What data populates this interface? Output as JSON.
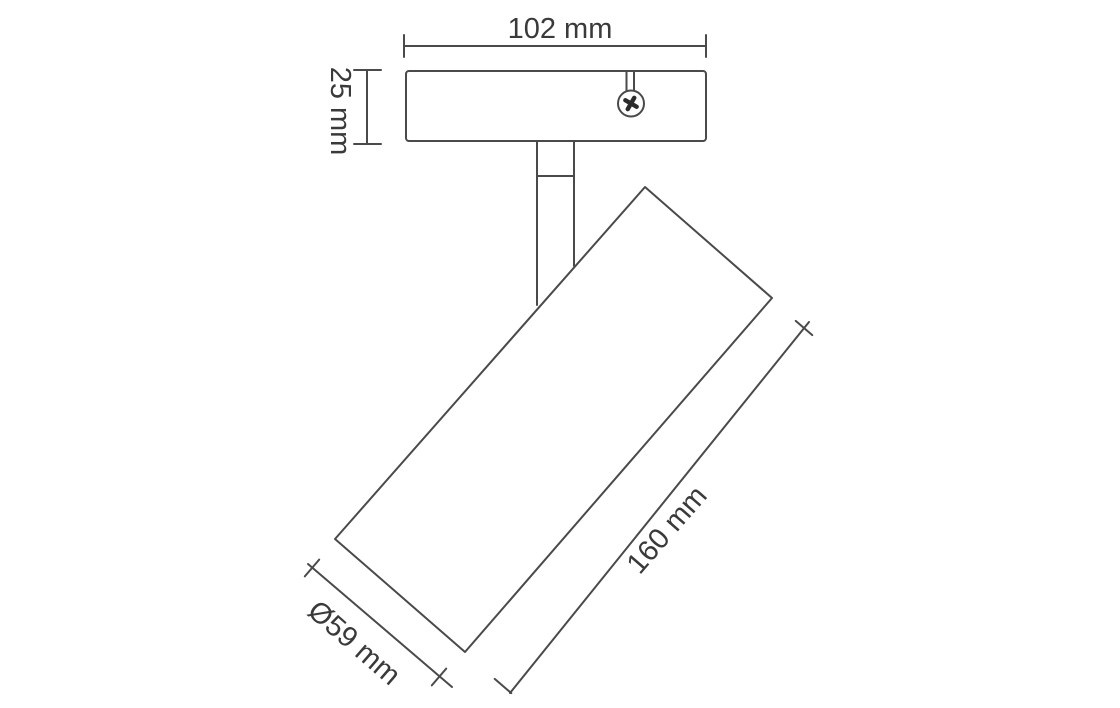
{
  "diagram": {
    "kind": "technical-dimension-drawing",
    "subject": "adjustable-spotlight-luminaire",
    "labels": {
      "plate_width": "102 mm",
      "plate_height": "25 mm",
      "body_length": "160 mm",
      "body_diameter": "Ø59 mm"
    },
    "icons": {
      "screw": "phillips-screw-head"
    },
    "colors": {
      "background": "#ffffff",
      "line": "#4a4a4a",
      "text": "#3a3a3a",
      "screw_cross": "#2b2b2b"
    }
  }
}
